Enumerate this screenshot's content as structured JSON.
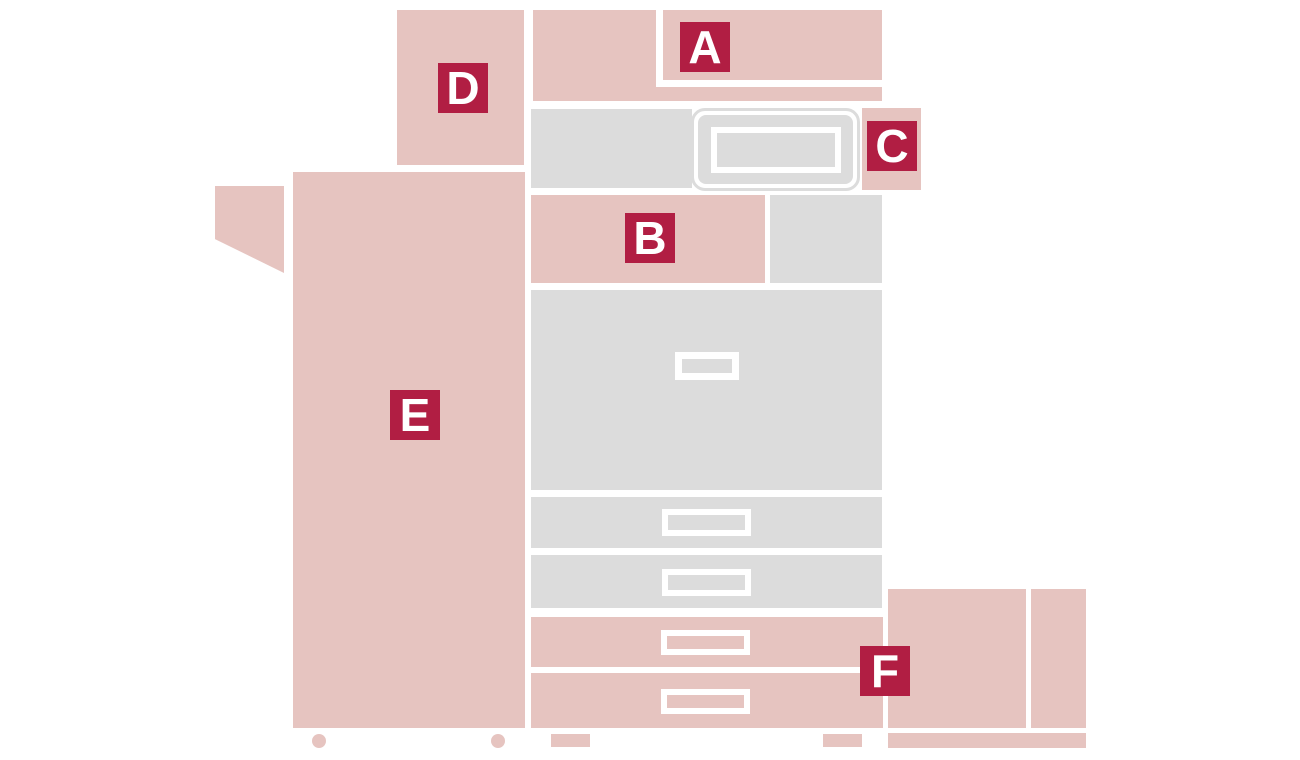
{
  "diagram": {
    "type": "printer-parts-options-diagram",
    "description": "Side-front schematic of a multifunction printer with lettered option markers",
    "labels": {
      "a": "A",
      "b": "B",
      "c": "C",
      "d": "D",
      "e": "E",
      "f": "F"
    },
    "colors": {
      "part_pink": "#e6c4c0",
      "label_crimson": "#b11e43",
      "machine_gray": "#dcdcdc",
      "background": "#ffffff",
      "label_text": "#ffffff"
    }
  }
}
